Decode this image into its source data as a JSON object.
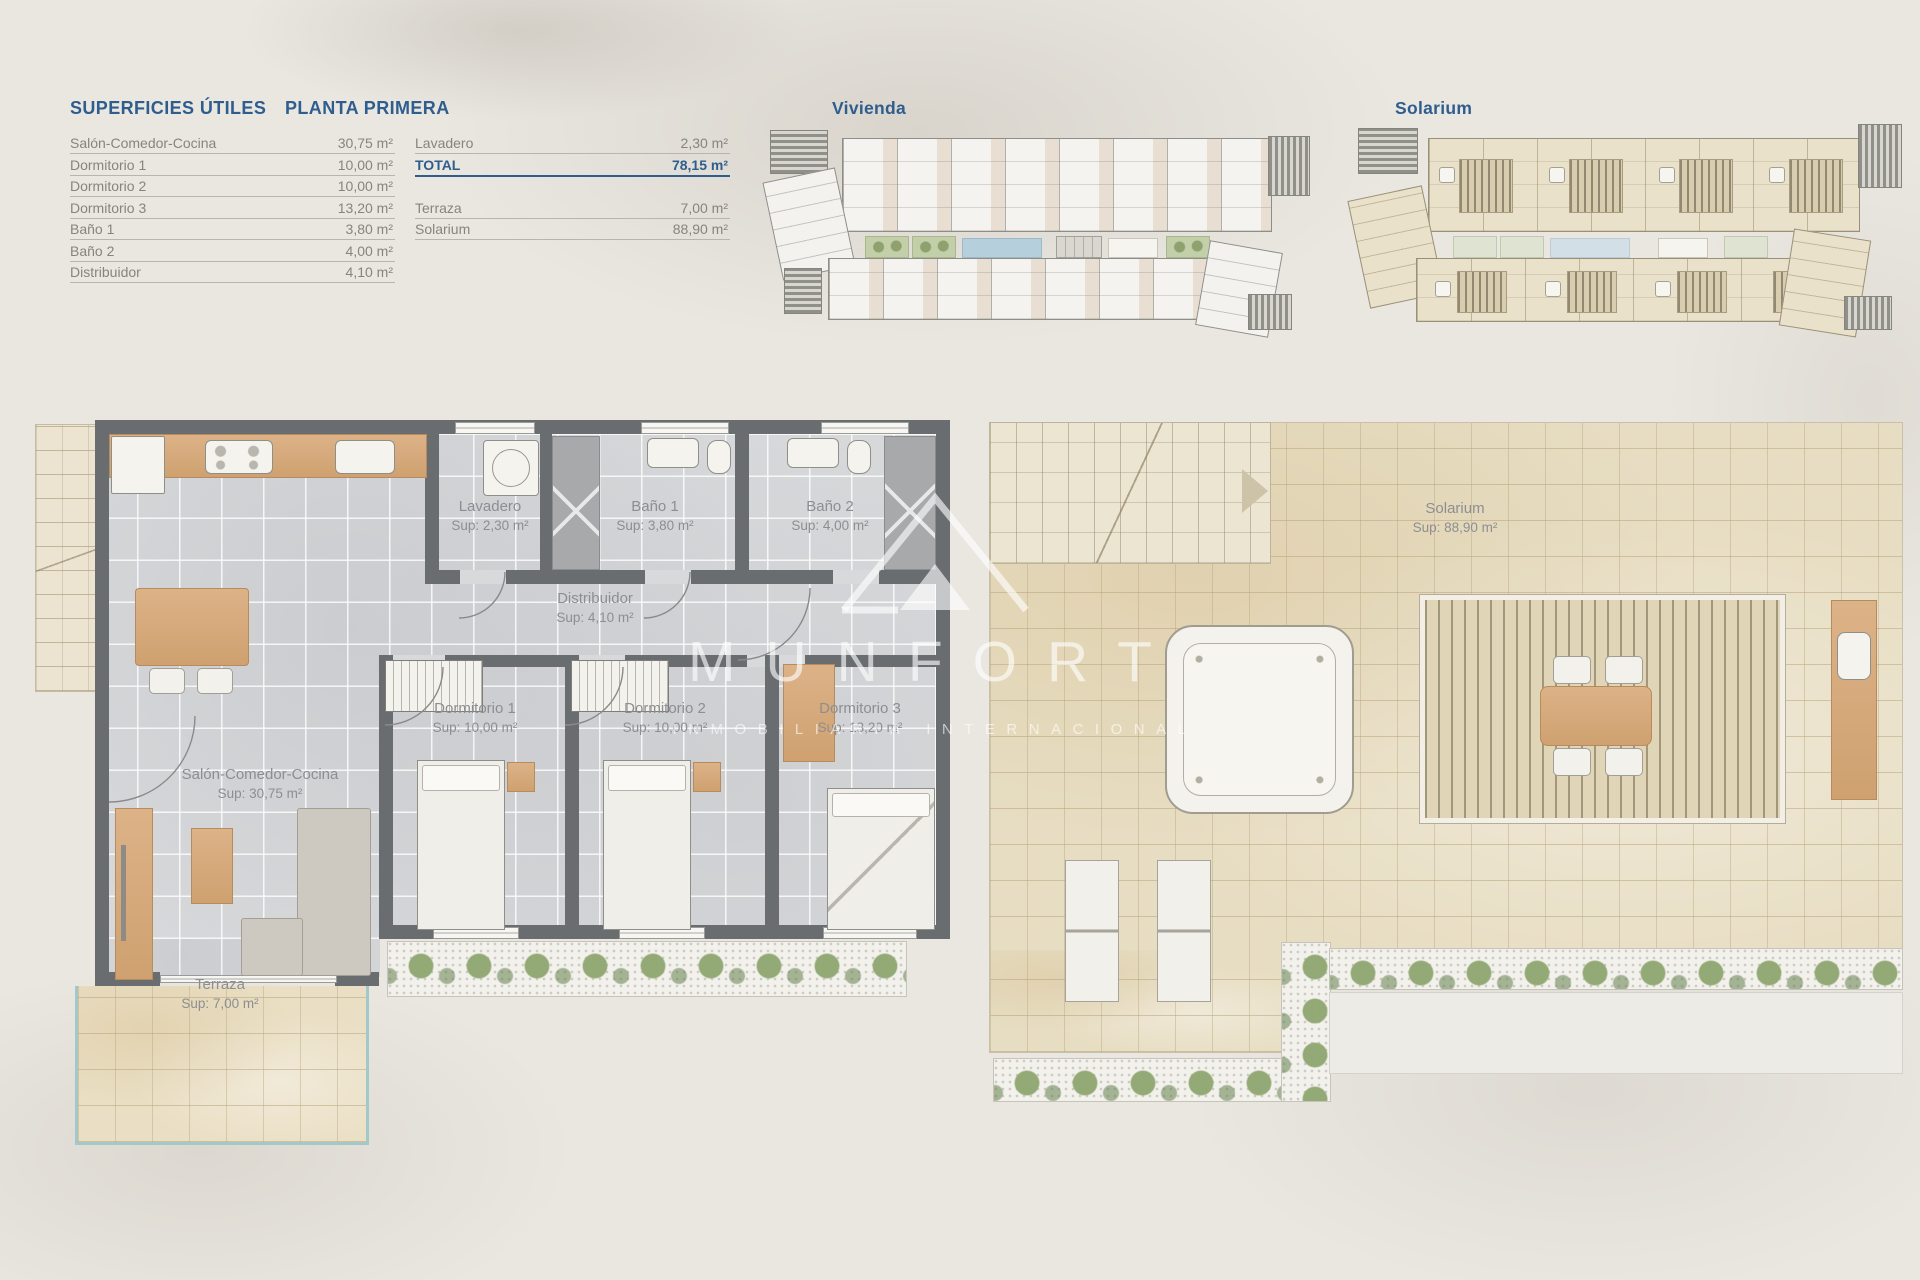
{
  "document": {
    "background_color": "#eae7e1",
    "headings": {
      "left": "SUPERFICIES ÚTILES",
      "right": "PLANTA PRIMERA"
    },
    "area_table": {
      "left_rows": [
        {
          "label": "Salón-Comedor-Cocina",
          "value": "30,75 m²"
        },
        {
          "label": "Dormitorio 1",
          "value": "10,00 m²"
        },
        {
          "label": "Dormitorio 2",
          "value": "10,00 m²"
        },
        {
          "label": "Dormitorio 3",
          "value": "13,20 m²"
        },
        {
          "label": "Baño 1",
          "value": "3,80 m²"
        },
        {
          "label": "Baño 2",
          "value": "4,00 m²"
        },
        {
          "label": "Distribuidor",
          "value": "4,10 m²"
        }
      ],
      "right_rows": [
        {
          "label": "Lavadero",
          "value": "2,30 m²"
        },
        {
          "label": "TOTAL",
          "value": "78,15 m²"
        },
        {
          "label": "Terraza",
          "value": "7,00 m²"
        },
        {
          "label": "Solarium",
          "value": "88,90 m²"
        }
      ]
    },
    "mini_plans": {
      "left_title": "Vivienda",
      "right_title": "Solarium"
    },
    "floor_plan_rooms": {
      "lavadero": {
        "name": "Lavadero",
        "sup": "Sup: 2,30 m²"
      },
      "bano1": {
        "name": "Baño 1",
        "sup": "Sup: 3,80 m²"
      },
      "bano2": {
        "name": "Baño 2",
        "sup": "Sup: 4,00 m²"
      },
      "distribuidor": {
        "name": "Distribuidor",
        "sup": "Sup: 4,10 m²"
      },
      "dormitorio1": {
        "name": "Dormitorio 1",
        "sup": "Sup: 10,00 m²"
      },
      "dormitorio2": {
        "name": "Dormitorio 2",
        "sup": "Sup: 10,00 m²"
      },
      "dormitorio3": {
        "name": "Dormitorio 3",
        "sup": "Sup: 13,20 m²"
      },
      "salon": {
        "name": "Salón-Comedor-Cocina",
        "sup": "Sup: 30,75 m²"
      },
      "terraza": {
        "name": "Terraza",
        "sup": "Sup: 7,00 m²"
      },
      "solarium": {
        "name": "Solarium",
        "sup": "Sup: 88,90 m²"
      }
    },
    "watermark": {
      "brand": "MUNFORT",
      "tagline": "INMOBILIARIA INTERNACIONAL"
    },
    "colors": {
      "heading_blue": "#2e5d8e",
      "table_text": "#87847d",
      "wall_gray": "#6a6d6f",
      "floor_tile": "#d7d8da",
      "wood": "#d4a97c",
      "beige_tile": "#e6dcc2",
      "plant_green": "#a9bd8d",
      "glass_teal": "#a2c8c9"
    }
  }
}
